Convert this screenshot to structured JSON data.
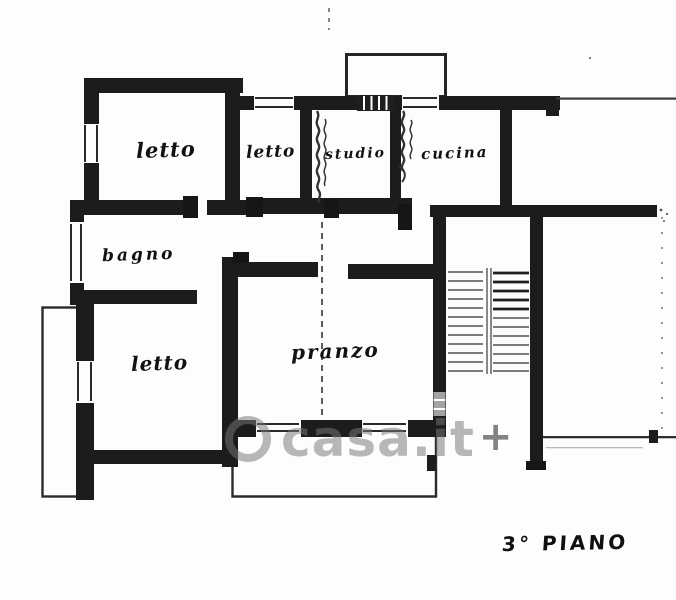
{
  "plan": {
    "rooms": {
      "letto_nw": {
        "label": "letto"
      },
      "letto_n": {
        "label": "letto"
      },
      "studio": {
        "label": "studio"
      },
      "cucina": {
        "label": "cucina"
      },
      "bagno": {
        "label": "bagno"
      },
      "letto_sw": {
        "label": "letto"
      },
      "pranzo": {
        "label": "pranzo"
      }
    },
    "floor_label": "3° PIANO",
    "watermark": {
      "text": "casa.it",
      "plus": "+"
    },
    "colors": {
      "wall": "#1c1c1c",
      "thin_line": "#2e2e2e",
      "watermark_gray": "#767676",
      "background": "#fdfdfc"
    }
  }
}
